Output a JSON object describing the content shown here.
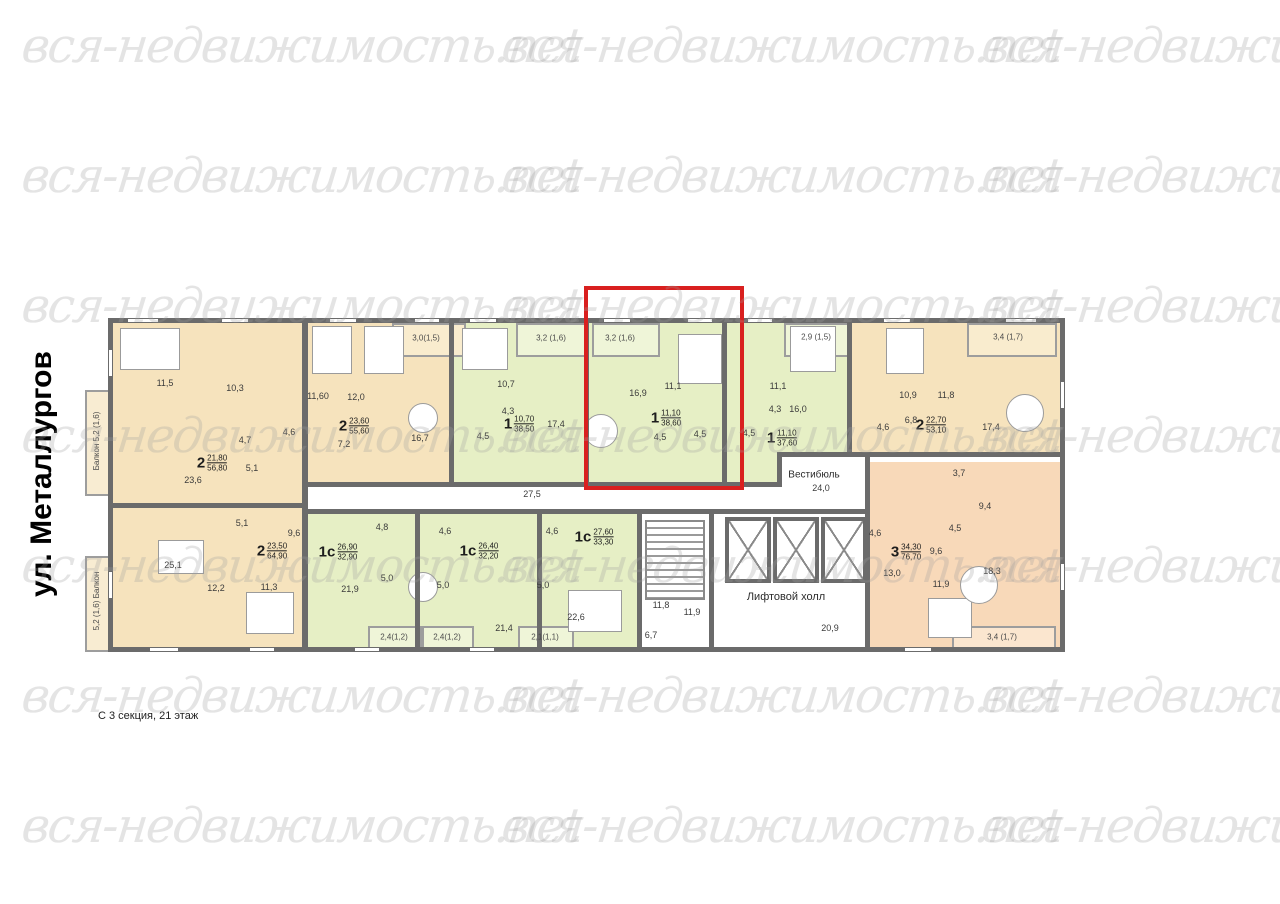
{
  "watermark": {
    "text": "вся-недвижимость.net"
  },
  "side_label": "ул. Металлургов",
  "caption": "С 3 секция, 21 этаж",
  "corridor_area": "27,5",
  "vestibule": {
    "name": "Вестибюль",
    "area": "24,0"
  },
  "lift_hall": {
    "name": "Лифтовой холл",
    "area": "20,9"
  },
  "stairwell": {
    "stairs_area": "11,8",
    "hall_area": "11,9",
    "lobby_area": "6,7"
  },
  "colors": {
    "wall": "#6b6b6b",
    "beige": "#f6e3bd",
    "green": "#e6efc5",
    "peach": "#f8d9b9",
    "highlight": "#d9201f"
  },
  "apartments": [
    {
      "type": "2",
      "living": "21,80",
      "total": "56,80",
      "rooms": [
        "11,5",
        "10,3",
        "4,7",
        "5,1",
        "23,6"
      ],
      "balcony_name": "Балкон",
      "balcony_area": "5,2 (1,6)"
    },
    {
      "type": "2",
      "living": "23,60",
      "total": "55,60",
      "rooms": [
        "11,60",
        "12,0",
        "4,6",
        "7,2",
        "16,7"
      ],
      "balcony_area": "3,0(1,5)"
    },
    {
      "type": "1",
      "living": "10,70",
      "total": "38,50",
      "rooms": [
        "10,7",
        "4,3",
        "17,4",
        "4,5"
      ],
      "balcony_area": "3,2 (1,6)"
    },
    {
      "type": "1",
      "living": "11,10",
      "total": "38,60",
      "highlighted": true,
      "rooms": [
        "16,9",
        "11,1",
        "4,5",
        "4,5"
      ],
      "balcony_area": "3,2 (1,6)"
    },
    {
      "type": "1",
      "living": "11,10",
      "total": "37,60",
      "rooms": [
        "11,1",
        "4,3",
        "16,0",
        "4,5"
      ],
      "balcony_area": "2,9 (1,5)"
    },
    {
      "type": "2",
      "living": "22,70",
      "total": "53,10",
      "rooms": [
        "10,9",
        "11,8",
        "6,8",
        "4,6",
        "17,4"
      ],
      "balcony_area": "3,4 (1,7)"
    },
    {
      "type": "2",
      "living": "23,50",
      "total": "64,90",
      "rooms": [
        "5,1",
        "9,6",
        "25,1",
        "12,2",
        "11,3"
      ],
      "balcony_name": "Балкон",
      "balcony_area": "5,2 (1,6)"
    },
    {
      "type": "1с",
      "living": "26,90",
      "total": "32,90",
      "rooms": [
        "4,8",
        "5,0",
        "21,9"
      ],
      "balcony_area": "2,4(1,2)"
    },
    {
      "type": "1с",
      "living": "26,40",
      "total": "32,20",
      "rooms": [
        "4,6",
        "5,0",
        "21,4"
      ],
      "balcony_area": "2,4(1,2)"
    },
    {
      "type": "1с",
      "living": "27,60",
      "total": "33,30",
      "rooms": [
        "4,6",
        "5,0",
        "22,6"
      ],
      "balcony_area": "2,1(1,1)"
    },
    {
      "type": "3",
      "living": "34,30",
      "total": "76,70",
      "rooms": [
        "3,7",
        "9,4",
        "4,5",
        "4,6",
        "9,6",
        "13,0",
        "11,9",
        "18,3"
      ],
      "balcony_area": "3,4 (1,7)"
    }
  ]
}
